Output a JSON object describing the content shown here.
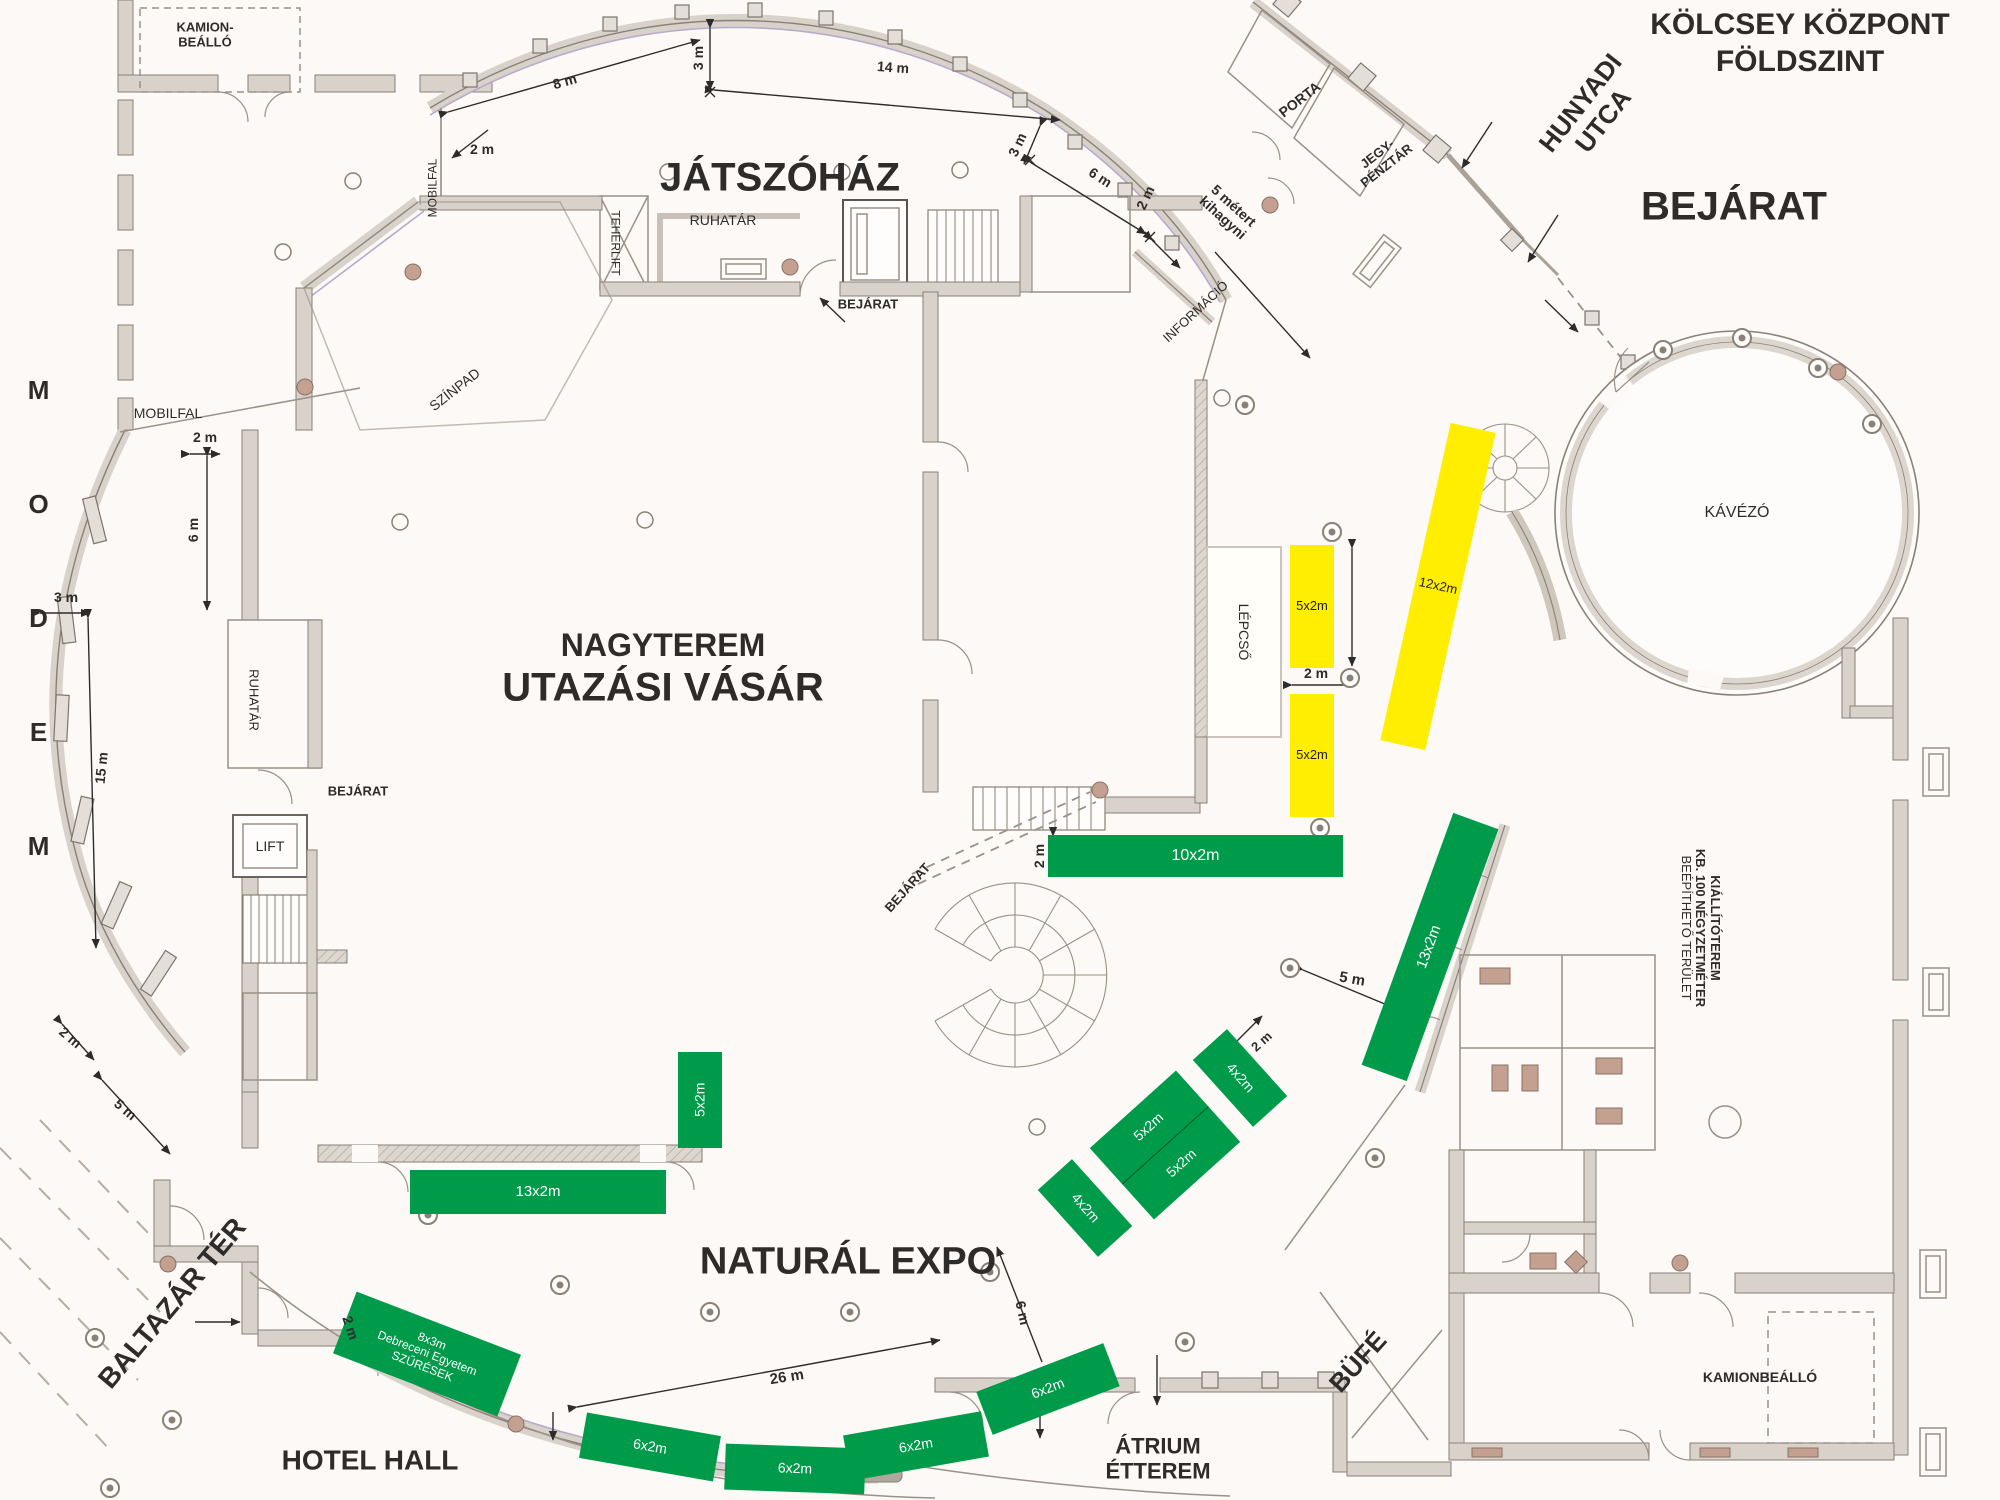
{
  "doc_title": {
    "line1": "KÖLCSEY KÖZPONT",
    "line2": "FÖLDSZINT"
  },
  "labels": {
    "hunyadi_1": "HUNYADI",
    "hunyadi_2": "UTCA",
    "bejarat_main": "BEJÁRAT",
    "jatszohaz": "JÁTSZÓHÁZ",
    "kamion_1": "KAMION-",
    "kamion_2": "BEÁLLÓ",
    "porta": "PORTA",
    "jegy_1": "JEGY-",
    "jegy_2": "PÉNZTÁR",
    "mobilfal_top": "MOBILFAL",
    "mobilfal_left": "MOBILFAL",
    "teherlift": "TEHERLIFT",
    "ruhatar_top": "RUHATÁR",
    "bejarat_top": "BEJÁRAT",
    "informacio": "INFORMÁCIÓ",
    "szinpad": "SZÍNPAD",
    "nagyterem": "NAGYTEREM",
    "utazasi": "UTAZÁSI VÁSÁR",
    "lepcso": "LÉPCSŐ",
    "kavezo": "KÁVÉZÓ",
    "modem": "MODEM",
    "ruhatar_left": "RUHATÁR",
    "bejarat_left": "BEJÁRAT",
    "lift": "LIFT",
    "bejarat_center": "BEJÁRAT",
    "kiallito_1": "KIÁLLÍTÓTEREM",
    "kiallito_2": "KB. 100 NÉGYZETMÉTER",
    "kiallito_3": "BEÉPÍTHETŐ TERÜLET",
    "natural_expo": "NATURÁL EXPO",
    "baltazar": "BALTAZÁR TÉR",
    "hotel_hall": "HOTEL HALL",
    "atrium_1": "ÁTRIUM",
    "atrium_2": "ÉTTEREM",
    "bufe": "BÜFÉ",
    "kamionbeallo": "KAMIONBEÁLLÓ"
  },
  "dims": [
    {
      "text": "8 m"
    },
    {
      "text": "3 m"
    },
    {
      "text": "14 m"
    },
    {
      "text": "3 m"
    },
    {
      "text": "6 m"
    },
    {
      "text": "2 m"
    },
    {
      "text": "5 métert"
    },
    {
      "text": "kihagyni"
    },
    {
      "text": "2 m"
    },
    {
      "text": "2 m"
    },
    {
      "text": "6 m"
    },
    {
      "text": "3 m"
    },
    {
      "text": "15 m"
    },
    {
      "text": "2 m"
    },
    {
      "text": "5 m"
    },
    {
      "text": "2 m"
    },
    {
      "text": "2 m"
    },
    {
      "text": "5 m"
    },
    {
      "text": "2 m"
    },
    {
      "text": "26 m"
    },
    {
      "text": "6 m"
    },
    {
      "text": "2 m"
    }
  ],
  "booths": {
    "green": [
      {
        "label": "10x2m"
      },
      {
        "label": "13x2m"
      },
      {
        "label": "5x2m"
      },
      {
        "label": "5x2m"
      },
      {
        "label": "4x2m"
      },
      {
        "label": "4x2m"
      },
      {
        "label": "13x2m"
      },
      {
        "label": "5x2m"
      },
      {
        "lines": [
          "8x3m",
          "Debreceni Egyetem",
          "SZŰRÉSEK"
        ]
      },
      {
        "label": "6x2m"
      },
      {
        "label": "6x2m"
      },
      {
        "label": "6x2m"
      },
      {
        "label": "6x2m"
      }
    ],
    "yellow": [
      {
        "label": "5x2m"
      },
      {
        "label": "5x2m"
      },
      {
        "label": "12x2m"
      }
    ]
  },
  "colors": {
    "booth_green": "#009b4a",
    "booth_yellow": "#ffee00",
    "wall_fill": "#d9d2ca",
    "wall_line": "#8a8076",
    "accent_violet": "#b7aacc",
    "door_accent": "#c4a091"
  }
}
